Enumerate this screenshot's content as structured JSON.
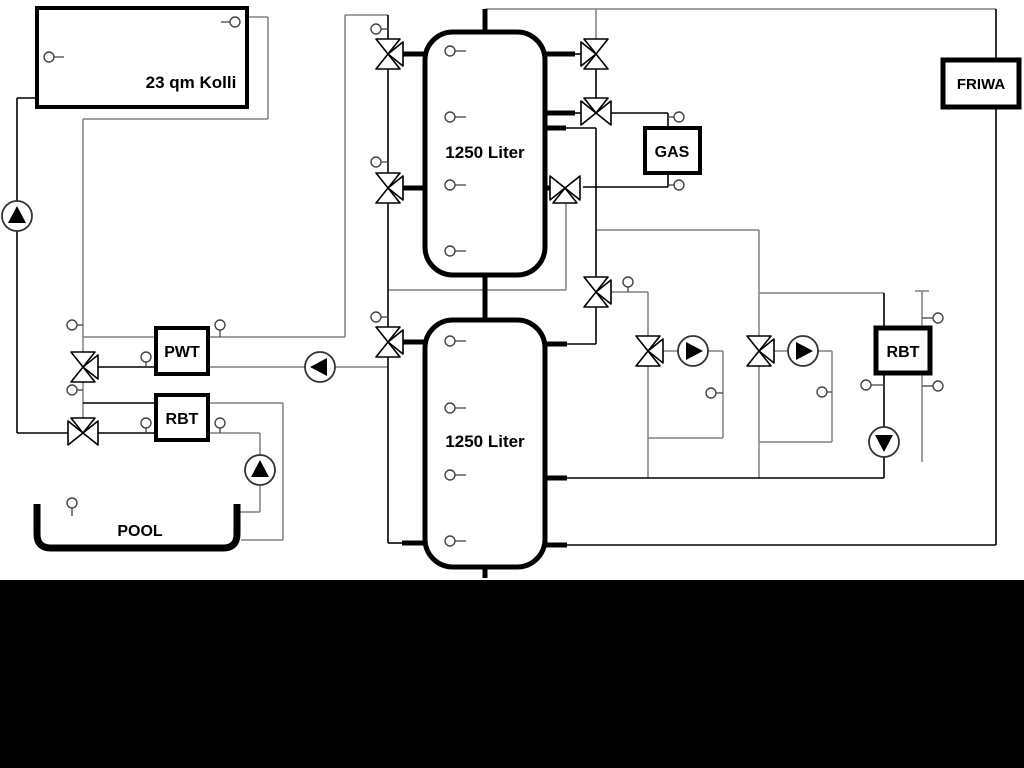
{
  "app": {
    "background_color": "#ffffff",
    "letterbox_color": "#000000"
  },
  "diagram": {
    "type": "hydraulic-heating-schematic",
    "labels": {
      "collector": "23 qm Kolli",
      "tank_top": "1250 Liter",
      "tank_bottom": "1250 Liter",
      "gas": "GAS",
      "friwa": "FRIWA",
      "pwt": "PWT",
      "rbt_left": "RBT",
      "rbt_right": "RBT",
      "pool": "POOL"
    },
    "equipment": [
      {
        "name": "solar-collector",
        "label": "23 qm Kolli"
      },
      {
        "name": "buffer-tank-top",
        "label": "1250 Liter"
      },
      {
        "name": "buffer-tank-bottom",
        "label": "1250 Liter"
      },
      {
        "name": "gas-boiler",
        "label": "GAS"
      },
      {
        "name": "fresh-water-station",
        "label": "FRIWA"
      },
      {
        "name": "plate-heat-exchanger",
        "label": "PWT"
      },
      {
        "name": "pool-heat-exchanger",
        "label": "RBT"
      },
      {
        "name": "right-heat-exchanger",
        "label": "RBT"
      },
      {
        "name": "pool-basin",
        "label": "POOL"
      }
    ],
    "counts": {
      "pumps": 6,
      "three_way_valves": 11,
      "temperature_sensors": 28
    },
    "colors": {
      "pipe_gray": "#808080",
      "pipe_black": "#000000",
      "component_border": "#000000",
      "pump_fill": "#000000"
    }
  }
}
